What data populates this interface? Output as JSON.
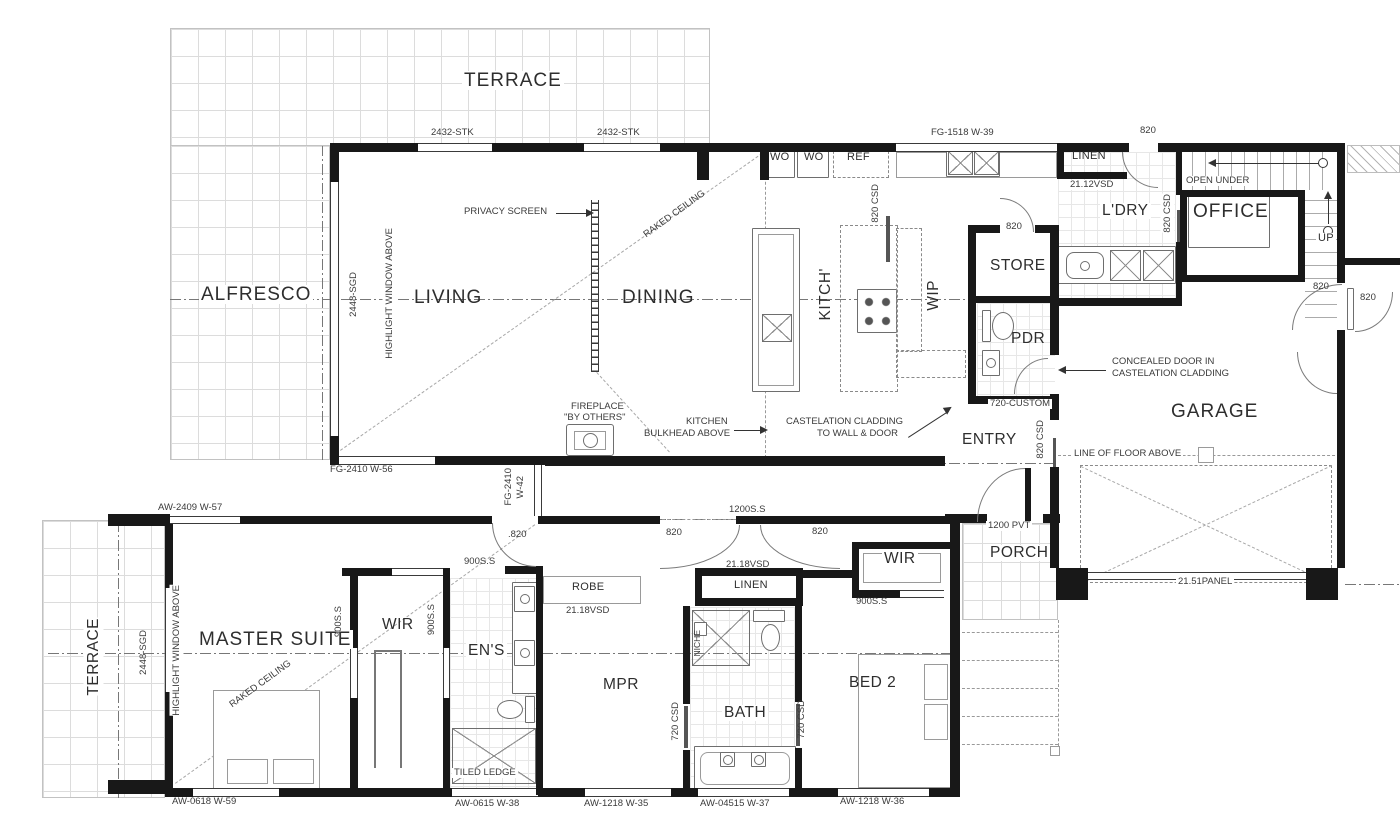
{
  "rooms": {
    "terrace_top": "TERRACE",
    "alfresco": "ALFRESCO",
    "living": "LIVING",
    "dining": "DINING",
    "kitchen": "KITCH'",
    "wip": "WIP",
    "store": "STORE",
    "pdr": "PDR",
    "laundry": "L'DRY",
    "linen_laundry": "LINEN",
    "office": "OFFICE",
    "garage": "GARAGE",
    "entry": "ENTRY",
    "porch": "PORCH",
    "terrace_bottom": "TERRACE",
    "master_suite": "MASTER SUITE",
    "wir_master": "WIR",
    "ens": "EN'S",
    "mpr": "MPR",
    "bath": "BATH",
    "bed2": "BED 2",
    "wir_bed2": "WIR",
    "linen_hall": "LINEN",
    "robe": "ROBE",
    "ref": "REF",
    "wo_left": "WO",
    "wo_right": "WO",
    "up": "UP",
    "open_under": "OPEN UNDER"
  },
  "notes": {
    "privacy_screen": "PRIVACY SCREEN",
    "raked_ceiling_living": "RAKED CEILING",
    "raked_ceiling_master": "RAKED CEILING",
    "fireplace_l1": "FIREPLACE",
    "fireplace_l2": "\"BY OTHERS\"",
    "bulkhead_l1": "KITCHEN",
    "bulkhead_l2": "BULKHEAD ABOVE",
    "cladding_l1": "CASTELATION CLADDING",
    "cladding_l2": "TO WALL & DOOR",
    "concealed_l1": "CONCEALED DOOR IN",
    "concealed_l2": "CASTELATION CLADDING",
    "line_of_floor": "LINE OF FLOOR ABOVE",
    "tiled_ledge": "TILED LEDGE",
    "highlight_window_top": "HIGHLIGHT WINDOW ABOVE",
    "highlight_window_bottom": "HIGHLIGHT WINDOW ABOVE",
    "niche": "NICHE"
  },
  "dims": {
    "stk_left": "2432-STK",
    "stk_right": "2432-STK",
    "fg1518": "FG-1518 W-39",
    "fg2410_56": "FG-2410 W-56",
    "fg2410_42a": "FG-2410",
    "fg2410_42b": "W-42",
    "aw2409": "AW-2409 W-57",
    "sgd_top": "2448-SGD",
    "sgd_bottom": "2448-SGD",
    "vsd2112": "21.12VSD",
    "vsd2118_robe": "21.18VSD",
    "vsd2118_linen": "21.18VSD",
    "pvt1200": "1200 PVT",
    "ss1200": "1200S.S",
    "ss900_hall": "900S.S",
    "ss900_wir": "900S.S",
    "ss900_ens": "900S.S",
    "ss900_bed2": "900S.S",
    "csd820_kitchen": "820 CSD",
    "csd820_entry": "820 CSD",
    "csd820_laundry": "820 CSD",
    "csd720_left": "720 CSD",
    "csd720_right": "720 CSD",
    "custom720": "720-CUSTOM",
    "panel2151": "21.51PANEL",
    "d820_store": "820",
    "d820_laundry": "820",
    "d820_hall": ".820",
    "d820_mpr_left": "820",
    "d820_mpr_right": "820",
    "d820_garage": "820",
    "d820_ext": "820",
    "aw0618": "AW-0618 W-59",
    "aw0615": "AW-0615 W-38",
    "aw1218_35": "AW-1218 W-35",
    "aw04515": "AW-04515 W-37",
    "aw1218_36": "AW-1218 W-36"
  }
}
